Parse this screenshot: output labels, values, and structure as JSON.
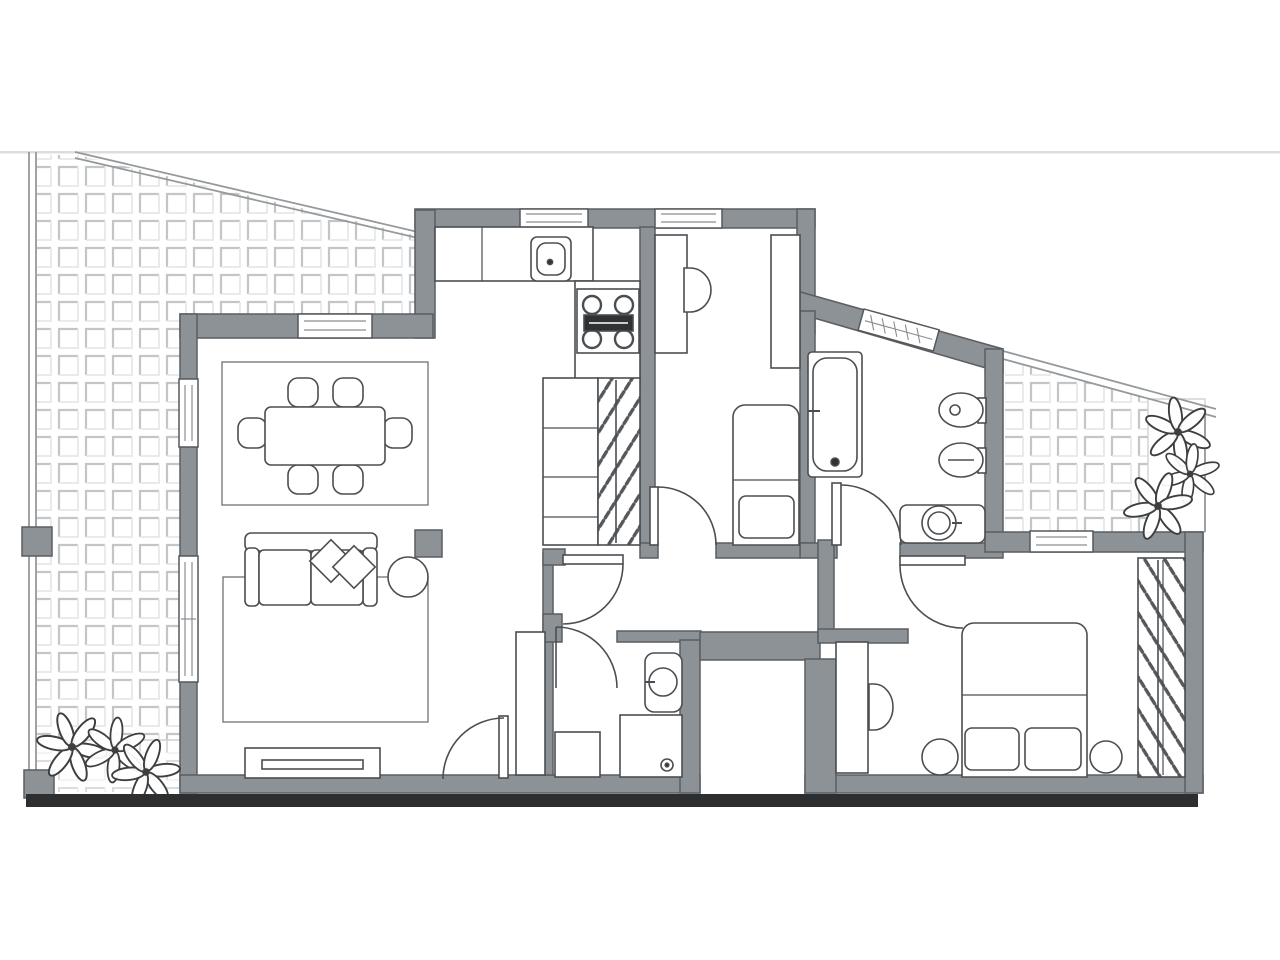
{
  "palette": {
    "background": "#ffffff",
    "wall_fill": "#8d9297",
    "wall_stroke": "#5a5e62",
    "furniture_stroke": "#4b4e51",
    "furniture_fill": "#ffffff",
    "thin_line": "#8a8e91",
    "tile_line": "#c3c6c8",
    "tile_line_soft": "#e7e8e9",
    "boundary_line": "#95999c",
    "baseline": "#2c2e30",
    "horizon": "#dcdddd",
    "stove_dark": "#2f3133",
    "plant_stroke": "#3c3e40",
    "rug_line": "#6e7275"
  },
  "floorplan": {
    "type": "apartment-floor-plan",
    "rooms": [
      {
        "name": "living-dining-room",
        "furniture": [
          "dining-table",
          "dining-chairs-x6",
          "dining-rug",
          "sofa",
          "throw-pillows-x2",
          "round-side-table",
          "living-rug",
          "tv-bench",
          "storage-closet",
          "column"
        ]
      },
      {
        "name": "kitchen",
        "furniture": [
          "counter",
          "kitchen-sink",
          "cooktop-4-burners",
          "cabinet-column",
          "shelf-cabinet",
          "pantry-closet-hangers"
        ]
      },
      {
        "name": "bedroom-small",
        "furniture": [
          "desk",
          "desk-chair",
          "wardrobe-cabinet",
          "single-bed",
          "pillow"
        ]
      },
      {
        "name": "bathroom",
        "furniture": [
          "bathtub",
          "bidet",
          "toilet",
          "washbasin-counter"
        ]
      },
      {
        "name": "wc-shower-room",
        "furniture": [
          "toilet",
          "shower-tray",
          "low-cabinet"
        ]
      },
      {
        "name": "bedroom-master",
        "furniture": [
          "double-bed",
          "pillows-x2",
          "nightstand-left",
          "nightstand-right",
          "desk",
          "desk-chair",
          "open-wardrobe-hangers"
        ]
      },
      {
        "name": "hallway",
        "furniture": []
      },
      {
        "name": "entry-porch",
        "furniture": []
      },
      {
        "name": "terrace-left",
        "features": [
          "paved-tile-grid",
          "diagonal-boundary",
          "plants-cluster",
          "planter-box",
          "boundary-post"
        ]
      },
      {
        "name": "terrace-right",
        "features": [
          "paved-tile-grid",
          "diagonal-boundary",
          "plants-cluster"
        ]
      }
    ],
    "openings": {
      "windows": 7,
      "doors": 6,
      "entrance_gaps": 1
    }
  }
}
